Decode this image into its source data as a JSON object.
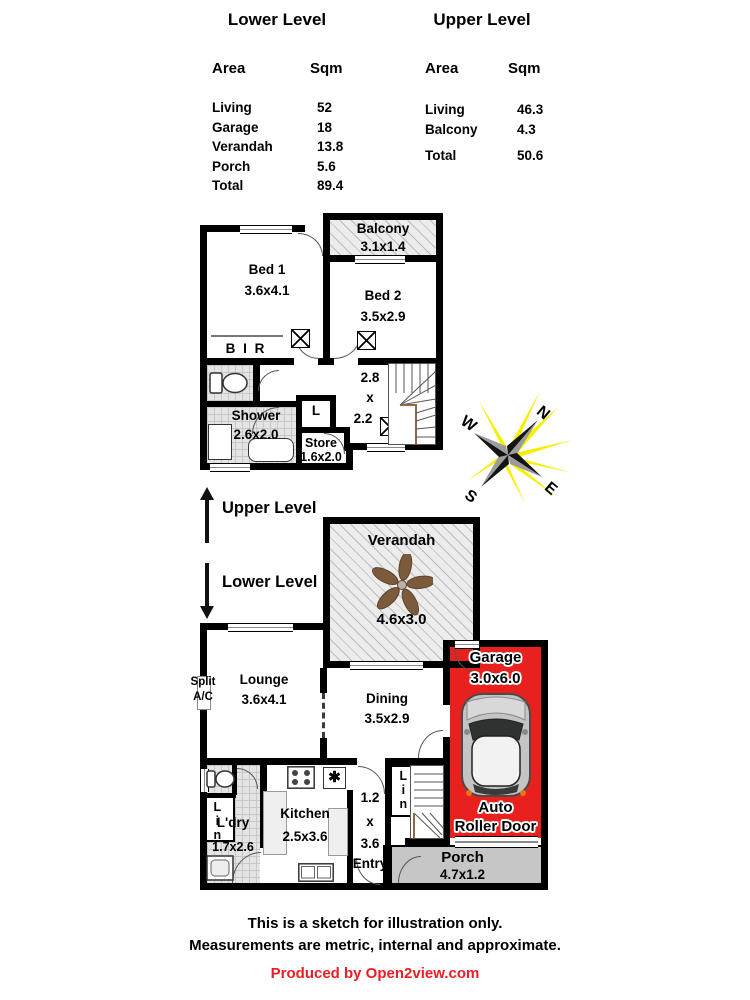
{
  "tables": {
    "lower": {
      "title": "Lower Level",
      "area_header": "Area",
      "sqm_header": "Sqm",
      "rows": [
        {
          "name": "Living",
          "sqm": "52"
        },
        {
          "name": "Garage",
          "sqm": "18"
        },
        {
          "name": "Verandah",
          "sqm": "13.8"
        },
        {
          "name": "Porch",
          "sqm": "5.6"
        }
      ],
      "total_label": "Total",
      "total_sqm": "89.4"
    },
    "upper": {
      "title": "Upper Level",
      "area_header": "Area",
      "sqm_header": "Sqm",
      "rows": [
        {
          "name": "Living",
          "sqm": "46.3"
        },
        {
          "name": "Balcony",
          "sqm": "4.3"
        }
      ],
      "total_label": "Total",
      "total_sqm": "50.6"
    }
  },
  "upper_plan": {
    "balcony": {
      "name": "Balcony",
      "dim": "3.1x1.4"
    },
    "bed1": {
      "name": "Bed 1",
      "dim": "3.6x4.1"
    },
    "bed2": {
      "name": "Bed 2",
      "dim": "3.5x2.9"
    },
    "bir": "B I R",
    "shower": {
      "name": "Shower",
      "dim": "2.6x2.0"
    },
    "linen": "L",
    "store": {
      "name": "Store",
      "dim": "1.6x2.0"
    },
    "hall": {
      "w": "2.8",
      "x": "x",
      "h": "2.2"
    }
  },
  "level_markers": {
    "upper": "Upper Level",
    "lower": "Lower Level"
  },
  "compass": {
    "n": "N",
    "e": "E",
    "s": "S",
    "w": "W"
  },
  "lower_plan": {
    "verandah": {
      "name": "Verandah",
      "dim": "4.6x3.0"
    },
    "split_ac": {
      "line1": "Split",
      "line2": "A/C"
    },
    "lounge": {
      "name": "Lounge",
      "dim": "3.6x4.1"
    },
    "dining": {
      "name": "Dining",
      "dim": "3.5x2.9"
    },
    "garage": {
      "name": "Garage",
      "dim": "3.0x6.0",
      "door_line1": "Auto",
      "door_line2": "Roller Door"
    },
    "kitchen": {
      "name": "Kitchen",
      "dim": "2.5x3.6"
    },
    "laundry": {
      "name": "L'dry",
      "dim": "1.7x2.6"
    },
    "linen_wc": "Lin",
    "entry": {
      "w": "1.2",
      "x": "x",
      "h": "3.6",
      "name": "Entry"
    },
    "linen_stairs": "Lin",
    "porch": {
      "name": "Porch",
      "dim": "4.7x1.2"
    }
  },
  "footer": {
    "line1": "This is a sketch for illustration only.",
    "line2": "Measurements are metric, internal and approximate.",
    "credit": "Produced by Open2view.com"
  },
  "colors": {
    "garage_red": "#e8211f",
    "porch_gray": "#c6c6c6",
    "credit_red": "#ed1c24",
    "sun_yellow": "#f8ee00",
    "wall_black": "#000000",
    "fan_brown": "#7b5b3b"
  }
}
